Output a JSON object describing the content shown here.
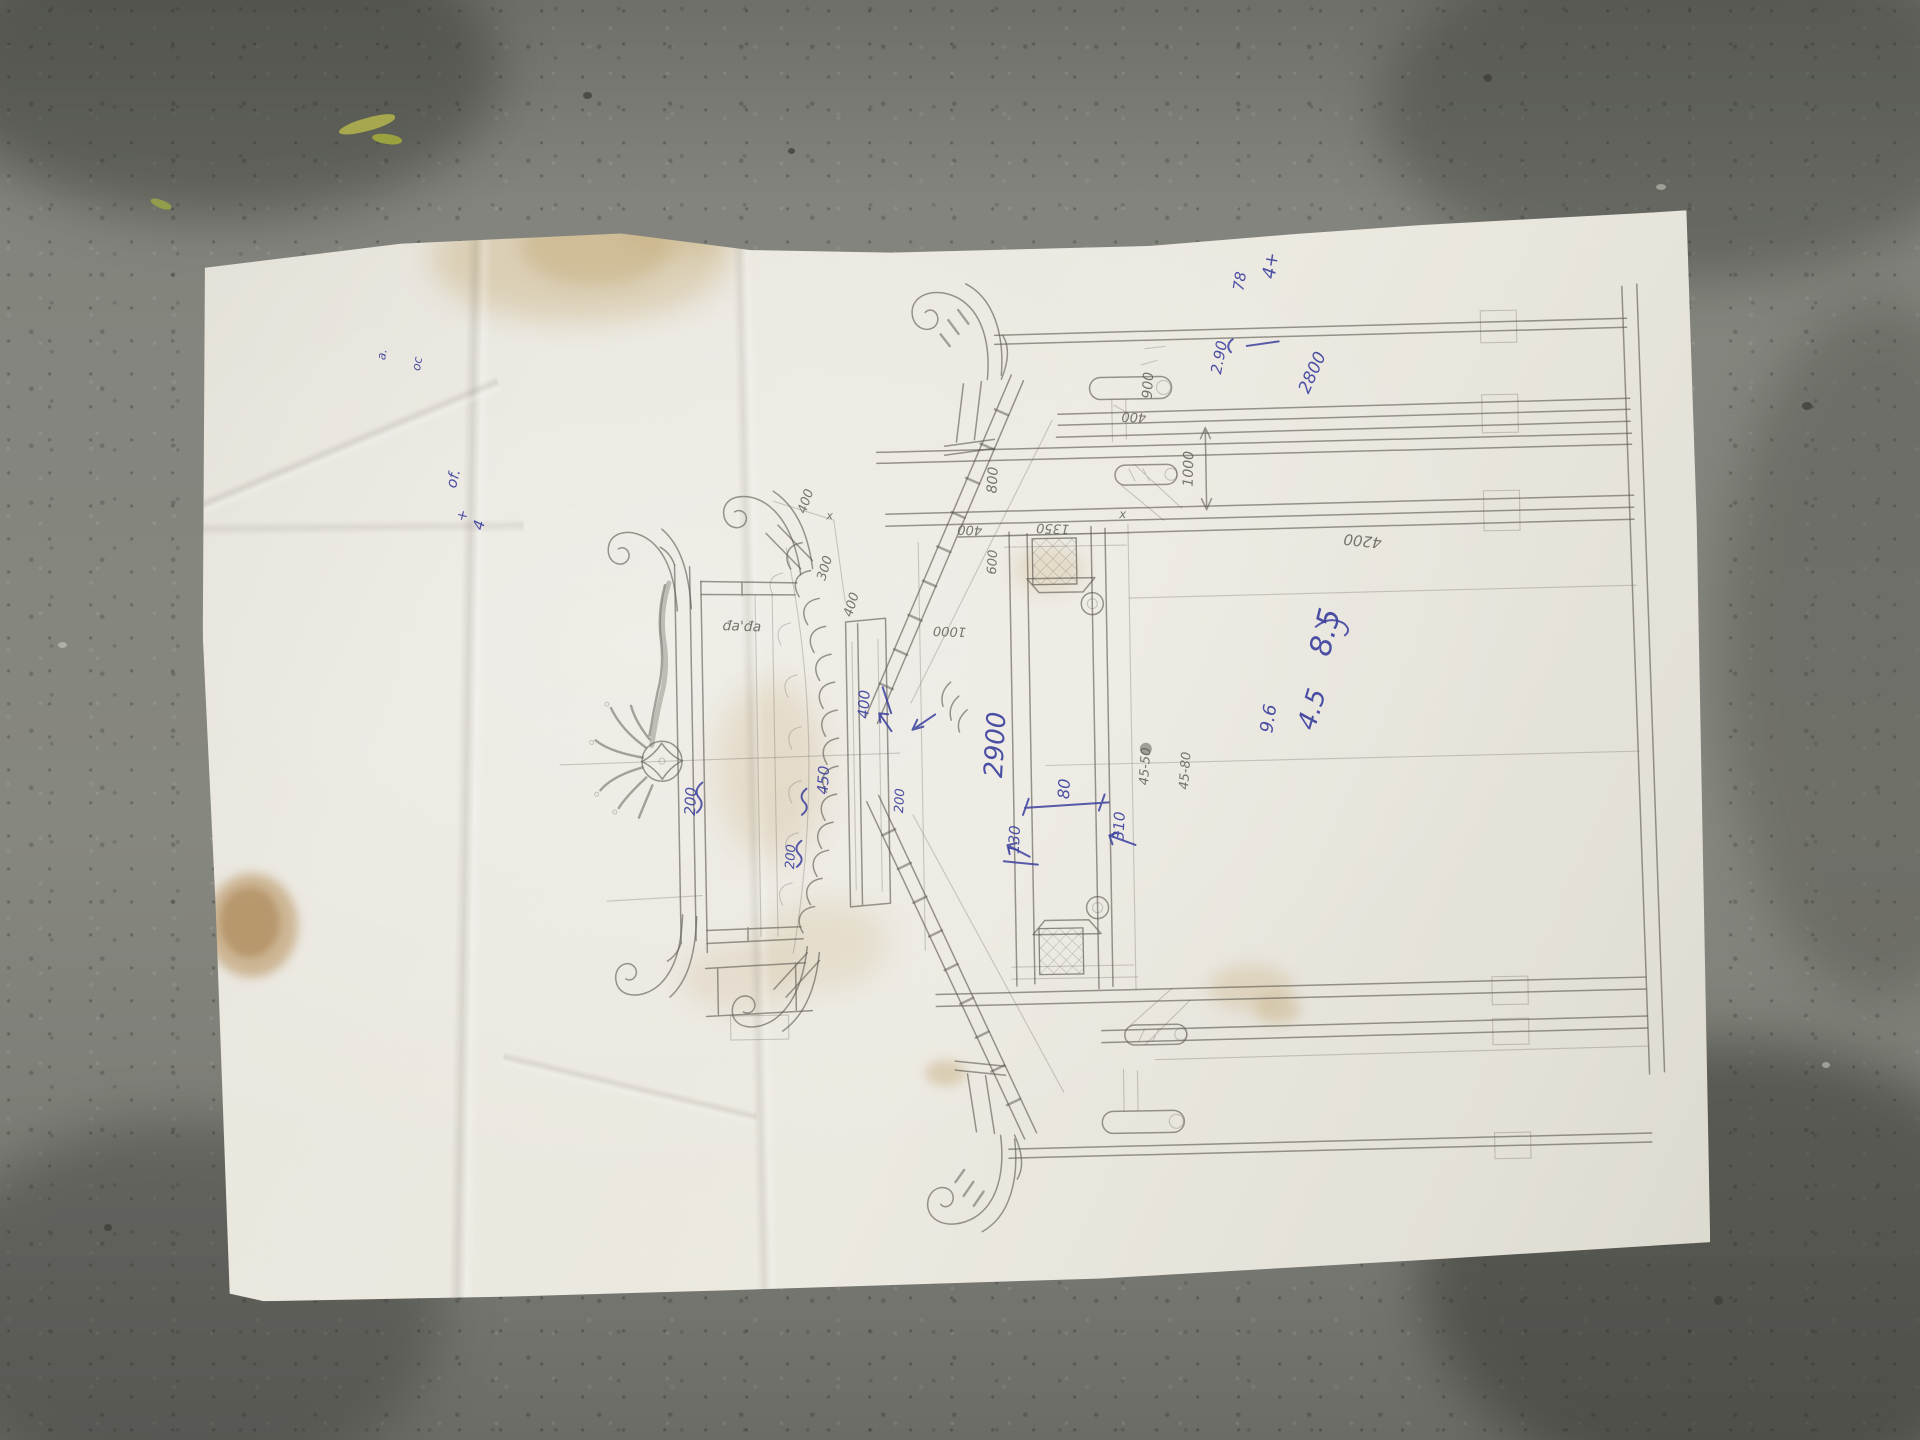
{
  "colors": {
    "paper": "#eae7df",
    "concrete": "#82837c",
    "concrete_dark": "#5f605a",
    "pencil": "#5d5b53",
    "ink_blue": "#3a3f9d",
    "stain": "#c8b48a"
  },
  "labels": {
    "ink": [
      "4+",
      "78",
      "2.90",
      "2800",
      "8.5",
      "4.5",
      "9.6",
      "2900",
      "80",
      "130",
      "310",
      "400",
      "200",
      "200",
      "450",
      "200",
      "a.",
      "oc",
      "of.",
      "4",
      "+"
    ],
    "pencil": [
      "900",
      "400",
      "1000",
      "800",
      "400",
      "1350",
      "x",
      "600",
      "4200",
      "45-80",
      "45-50",
      "400",
      "x",
      "300",
      "400",
      "đa'đa",
      "1000"
    ]
  }
}
